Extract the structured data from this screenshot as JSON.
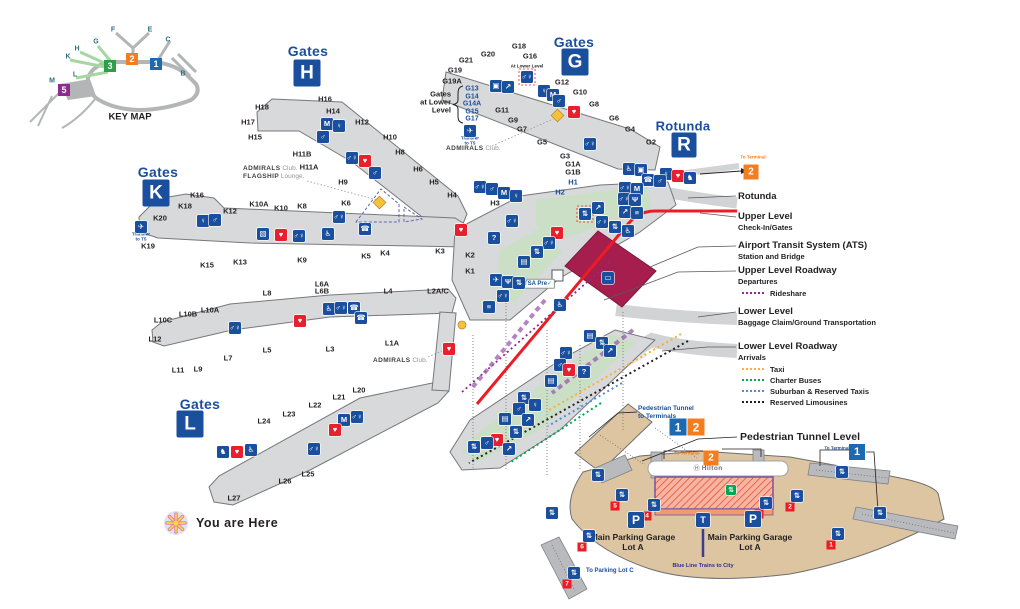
{
  "keymap": {
    "caption": "KEY MAP",
    "letters": [
      "F",
      "E",
      "C",
      "B",
      "G",
      "H",
      "K",
      "L",
      "M"
    ],
    "terminals": [
      {
        "num": "3",
        "color": "#2f9e49"
      },
      {
        "num": "2",
        "color": "#f47d20"
      },
      {
        "num": "1",
        "color": "#1d6ab0"
      },
      {
        "num": "5",
        "color": "#8f2a90"
      }
    ]
  },
  "headings": {
    "gates_word": "Gates",
    "h": "H",
    "g": "G",
    "k": "K",
    "l": "L",
    "rotunda": "Rotunda",
    "r": "R"
  },
  "gates": {
    "h": [
      "H18",
      "H17",
      "H16",
      "H15",
      "H14",
      "H12",
      "H11B",
      "H11A",
      "H10",
      "H9",
      "H8",
      "H6",
      "H5",
      "H4",
      "H3",
      "H2",
      "H1"
    ],
    "g": [
      "G21",
      "G20",
      "G19",
      "G19A",
      "G18",
      "G16",
      "G12",
      "G11",
      "G10",
      "G9",
      "G8",
      "G7",
      "G6",
      "G5",
      "G4",
      "G3",
      "G2",
      "G1A",
      "G1B"
    ],
    "k": [
      "K20",
      "K19",
      "K18",
      "K16",
      "K15",
      "K13",
      "K12",
      "K10A",
      "K10",
      "K9",
      "K8",
      "K6",
      "K5",
      "K4",
      "K3",
      "K2",
      "K1"
    ],
    "l": [
      "L12",
      "L11",
      "L10C",
      "L10B",
      "L10A",
      "L9",
      "L8",
      "L7",
      "L6A",
      "L6B",
      "L5",
      "L4",
      "L3",
      "L2A/C",
      "L1A",
      "L20",
      "L21",
      "L22",
      "L23",
      "L24",
      "L25",
      "L26",
      "L27"
    ]
  },
  "lower_level_gates": {
    "title_lines": [
      "Gates",
      "at Lower",
      "Level"
    ],
    "gates": [
      "G13",
      "G14",
      "G14A",
      "G15",
      "G17"
    ]
  },
  "annotations": {
    "admirals_b": "ADMIRALS",
    "admirals_r": " Club.",
    "flagship_b": "FLAGSHIP",
    "flagship_r": " Lounge.",
    "transfer_l1": "Transfer",
    "transfer_l2": "to T5",
    "at_lower_level": "At Lower Level",
    "tsa": "TSA Pre",
    "tsa_check": "✓",
    "you_are_here": "You are Here"
  },
  "legend": {
    "to_terminal_text": "To Terminal",
    "to_terminal_num": "2",
    "items": [
      {
        "title": "Rotunda",
        "subs": [],
        "dots": []
      },
      {
        "title": "Upper Level",
        "subs": [
          "Check-In/Gates"
        ],
        "dots": []
      },
      {
        "title": "Airport Transit System (ATS)",
        "subs": [
          "Station and Bridge"
        ],
        "dots": []
      },
      {
        "title": "Upper Level Roadway",
        "subs": [
          "Departures"
        ],
        "dots": [
          {
            "label": "Rideshare",
            "color": "#92278f"
          }
        ]
      },
      {
        "title": "Lower Level",
        "subs": [
          "Baggage Claim/Ground Transportation"
        ],
        "dots": []
      },
      {
        "title": "Lower Level Roadway",
        "subs": [
          "Arrivals"
        ],
        "dots": [
          {
            "label": "Taxi",
            "color": "#f9b233"
          },
          {
            "label": "Charter Buses",
            "color": "#00a651"
          },
          {
            "label": "Suburban & Reserved Taxis",
            "color": "#4a90d9"
          },
          {
            "label": "Reserved Limousines",
            "color": "#231f20"
          }
        ]
      }
    ]
  },
  "parking": {
    "tunnel_to_terminals_l1": "Pedestrian Tunnel",
    "tunnel_to_terminals_l2": "to Terminals",
    "tunnel_terminals": [
      {
        "num": "1",
        "color": "#1d6ab0"
      },
      {
        "num": "2",
        "color": "#f47d20"
      }
    ],
    "tunnel_level": "Pedestrian Tunnel Level",
    "to_terminal": "To Terminal",
    "terminal2": "2",
    "terminal1": "1",
    "hotel_mark": "Ⓗ",
    "hotel_name": "Hilton",
    "garage_l1": "Main Parking Garage",
    "garage_l2": "Lot A",
    "blue_line": "Blue Line Trains to City",
    "to_parking_lot_c": "To Parking Lot C",
    "elevator_numbers": [
      "1",
      "2",
      "3",
      "4",
      "5",
      "6",
      "7"
    ]
  },
  "icons": {
    "glyphs": {
      "restroom": "♂♀",
      "mens": "♂",
      "womens": "♀",
      "nursing": "M",
      "family": "♂♀",
      "elevator": "⇅",
      "escalator": "↗",
      "stairs": "≡",
      "aed": "♥",
      "info": "?",
      "baggage": "▤",
      "bus": "▭",
      "accessible": "♿",
      "transfer": "✈",
      "phone": "☎",
      "workstation": "▧",
      "kiosk": "▣",
      "dining": "Ψ",
      "pet": "♞",
      "train": "T",
      "parking": "P",
      "club": "▣",
      "hotel": "⇅"
    }
  },
  "colors": {
    "accent_blue": "#1a4f9d",
    "aed_red": "#e8202e",
    "roadway_red": "#ed1c24",
    "ats_maroon": "#a51e4d",
    "terminal_orange": "#f47d20",
    "terminal_blue": "#1d6ab0",
    "terminal_green": "#2f9e49",
    "terminal_purple": "#8f2a90",
    "taxi": "#f9b233",
    "charter_buses": "#00a651",
    "suburban_taxis": "#4a90d9",
    "reserved_limousines": "#231f20",
    "rideshare": "#92278f",
    "parking_tan": "#dcc5a0"
  }
}
